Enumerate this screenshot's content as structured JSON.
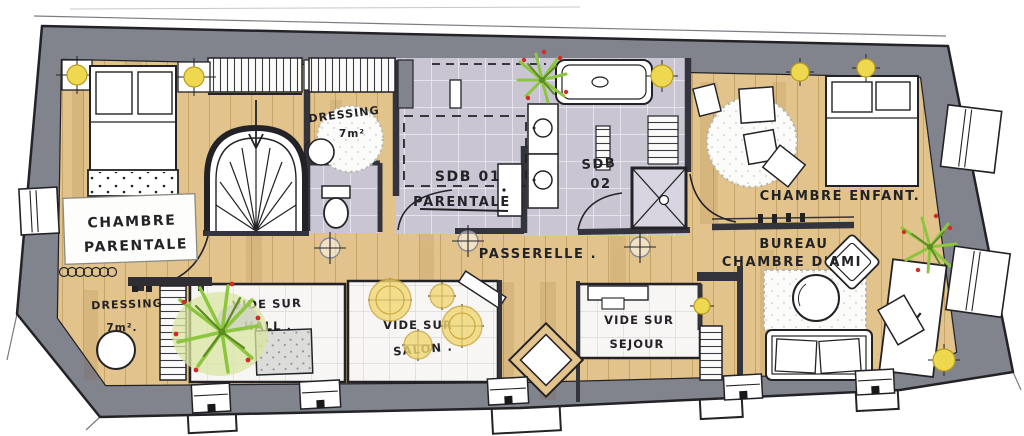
{
  "colors": {
    "wall": "#82848d",
    "wallseg": "#34343c",
    "wood": "#e2c38b",
    "wood_line": "#b08a4a",
    "tile": "#c9c5d3",
    "white_floor": "#f7f6f4",
    "floor_line": "#d7d5d0",
    "ink": "#232327",
    "accent_yellow": "#eed84f",
    "plant_green": "#8cc63f",
    "plant_dark": "#5d8a22",
    "berry_red": "#d22b27"
  },
  "plan": {
    "rooms": {
      "chambre_parentale": {
        "line1": "CHAMBRE",
        "line2": "PARENTALE"
      },
      "dressing_haut": {
        "line1": "DRESSING",
        "line2": "7m²"
      },
      "sdb01": {
        "line1": "SDB 01",
        "line2": "PARENTALE"
      },
      "sdb02": {
        "line1": "SDB",
        "line2": "02"
      },
      "chambre_enfant": {
        "line1": "CHAMBRE ENFANT."
      },
      "bureau": {
        "line1": "BUREAU",
        "line2": "CHAMBRE D'AMI"
      },
      "passerelle": {
        "line1": "PASSERELLE ."
      },
      "dressing_bas": {
        "line1": "DRESSING",
        "line2": "7m²."
      },
      "vide_hall": {
        "line1": "VIDE SUR",
        "line2": "HALL ."
      },
      "vide_salon": {
        "line1": "VIDE SUR",
        "line2": "SALON ."
      },
      "vide_sejour": {
        "line1": "VIDE SUR",
        "line2": "SEJOUR"
      }
    }
  }
}
